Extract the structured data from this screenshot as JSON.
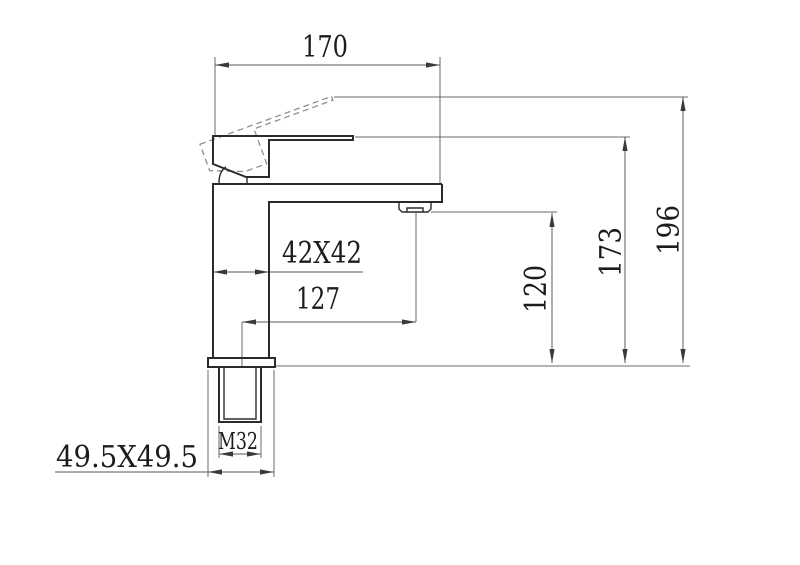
{
  "drawing": {
    "type": "faucet-technical-dimension-drawing",
    "line_colors": {
      "object": "#2b2b2b",
      "dimension": "#5a5a5a",
      "dashed_alternate_position": "#8f8f8f",
      "background": "#ffffff",
      "text": "#1c1c1c"
    },
    "dimensions": {
      "overall_spout_width": "170",
      "body_cross_section": "42X42",
      "spout_center_reach": "127",
      "spout_outlet_height": "120",
      "spout_top_height": "173",
      "max_height_lever_raised": "196",
      "inlet_thread_size": "M32",
      "base_plate_size": "49.5X49.5"
    }
  }
}
